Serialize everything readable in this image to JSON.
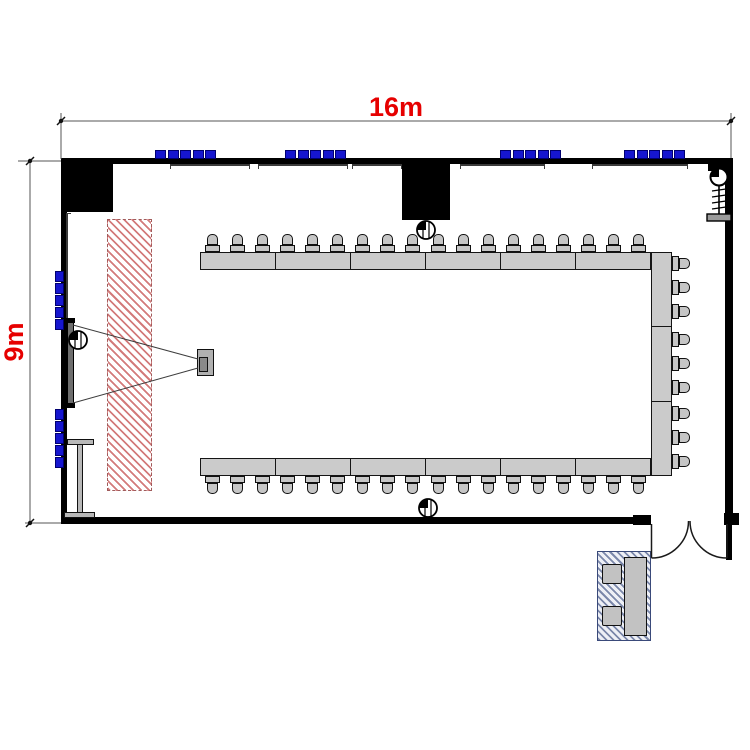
{
  "title": "Meeting room floor plan (U-shape layout)",
  "dimensions": {
    "width_label": "16m",
    "height_label": "9m"
  },
  "colors": {
    "dimension_text_red": "#e60000",
    "wall_black": "#000000",
    "furniture_gray": "#c9c9c9",
    "light_strip_blue": "#1616cf",
    "screen_zone_hatch_red": "#cf8080",
    "reception_hatch_blue": "#3e5082"
  },
  "furniture": {
    "top_table_count": 6,
    "bottom_table_count": 6,
    "right_table_count": 3,
    "chairs_per_table": 3,
    "top_chair_count": 18,
    "bottom_chair_count": 18,
    "right_chair_count": 9,
    "total_tables": 15,
    "total_chairs": 45,
    "reception_chair_count": 2
  },
  "lights": {
    "top_group_count": 4,
    "left_group_count": 2,
    "squares_per_group": 5
  },
  "equipment": [
    "projector",
    "projection-screen",
    "screen-clearance-zone",
    "mobile-whiteboard",
    "ceiling-speakers",
    "coat-rack",
    "double-swing-door",
    "reception-desk"
  ]
}
